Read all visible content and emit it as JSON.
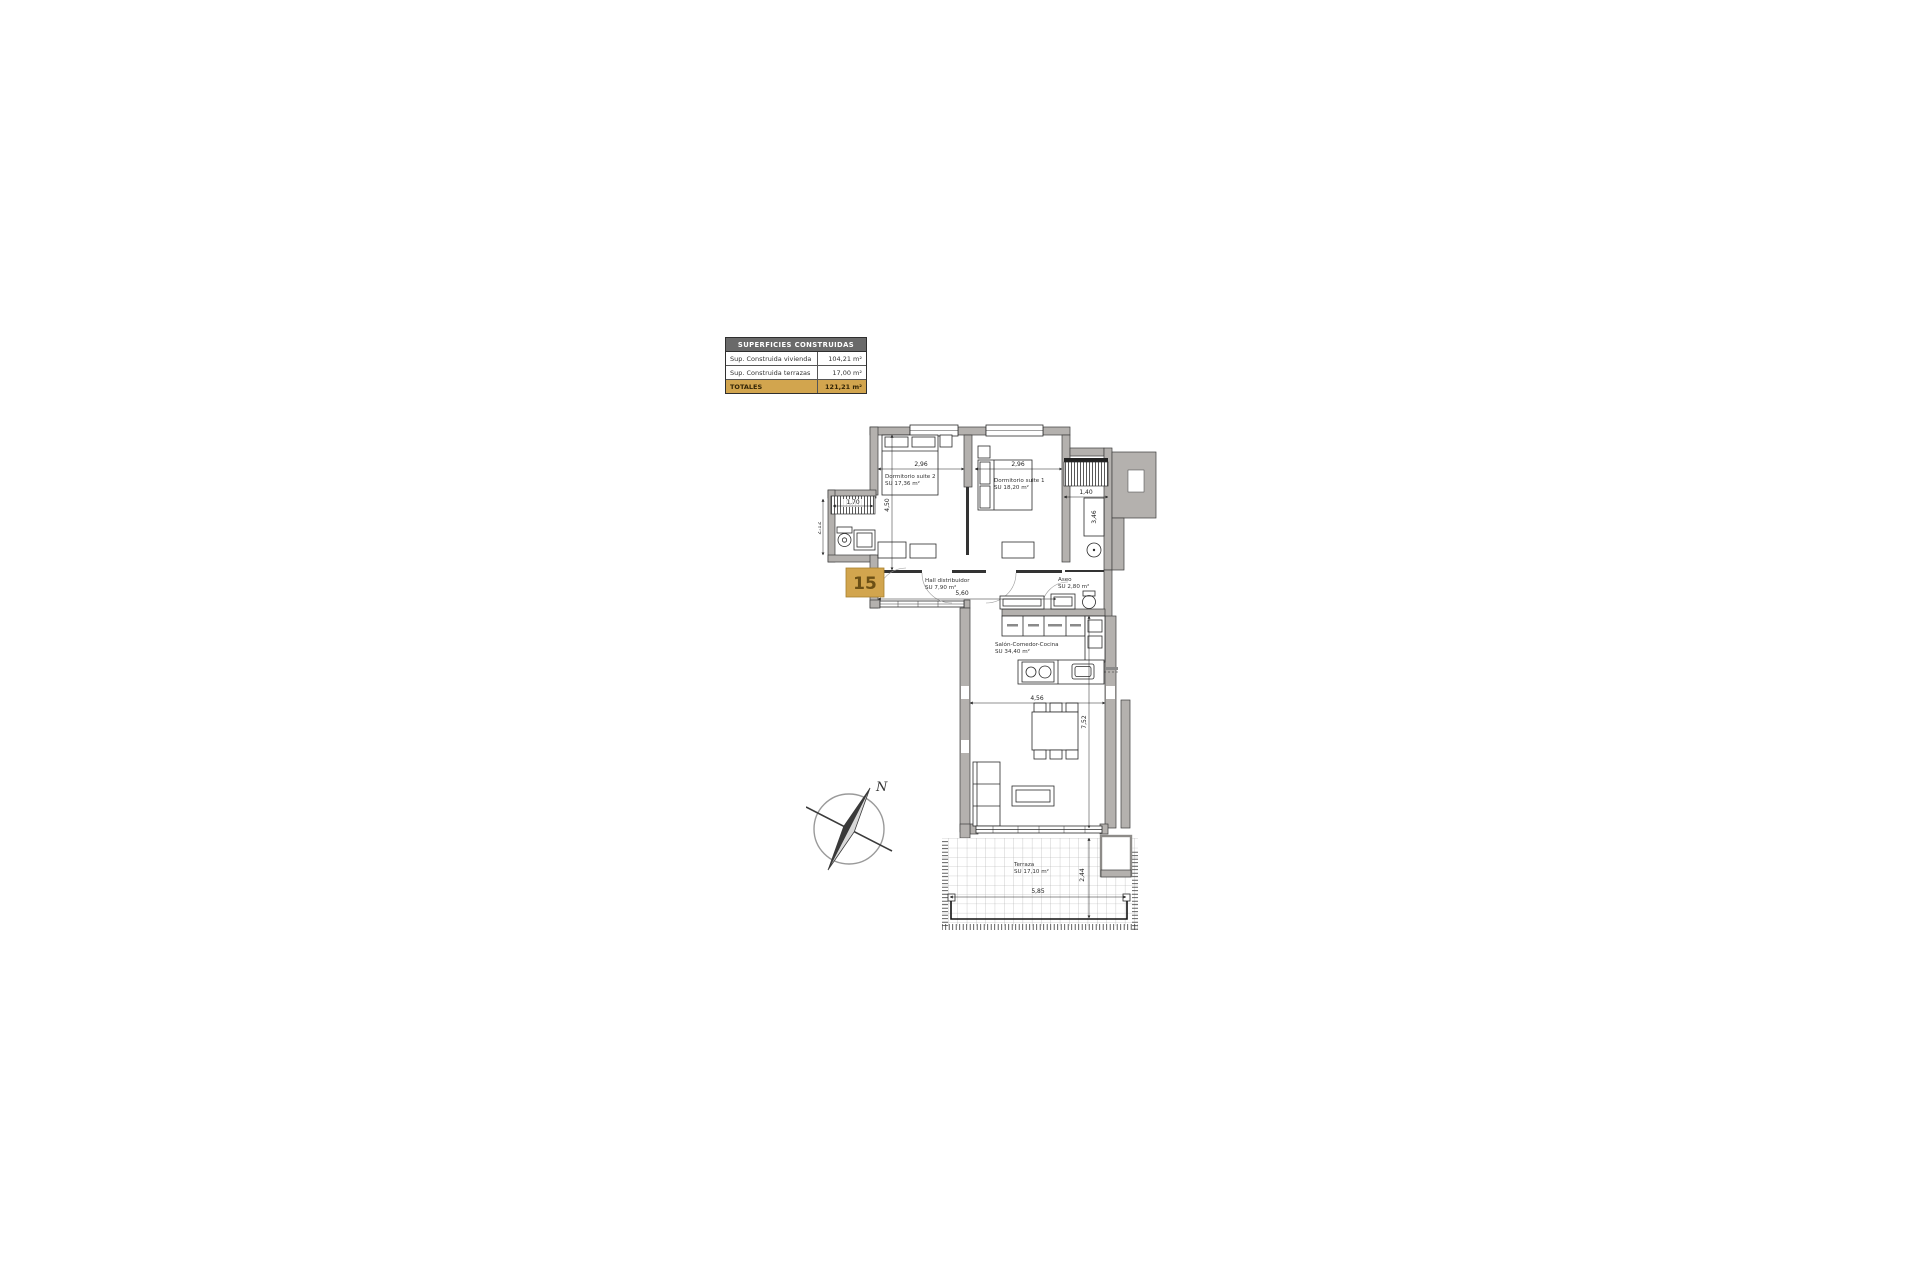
{
  "summary_table": {
    "header": "SUPERFICIES CONSTRUIDAS",
    "rows": [
      {
        "label": "Sup. Construida vivienda",
        "value": "104,21 m²"
      },
      {
        "label": "Sup. Construida terrazas",
        "value": "17,00 m²"
      }
    ],
    "total_row": {
      "label": "TOTALES",
      "value": "121,21 m²"
    }
  },
  "plan": {
    "unit_number": "15",
    "compass_north": "N",
    "rooms": {
      "suite2": {
        "name": "Dormitorio suite 2",
        "area": "SU  17,36 m²"
      },
      "suite1": {
        "name": "Dormitorio suite 1",
        "area": "SU  18,20 m²"
      },
      "hall": {
        "name": "Hall distribuidor",
        "area": "SU  7,90 m²"
      },
      "aseo": {
        "name": "Aseo",
        "area": "SU  2,80 m²"
      },
      "salon": {
        "name": "Salón-Comedor-Cocina",
        "area": "SU  34,40 m²"
      },
      "terraza": {
        "name": "Terraza",
        "area": "SU  17,10 m²"
      }
    },
    "dimensions": {
      "suite2_width": "2,96",
      "suite1_width": "2,96",
      "suite2_depth": "4,50",
      "bath_window": "1,70",
      "bath_depth": "2,12",
      "gallery_width": "1,40",
      "wardrobe_depth": "3,46",
      "hall_width": "5,60",
      "salon_width": "4,56",
      "salon_depth": "7,52",
      "terrace_width": "5,85",
      "terrace_depth": "2,44"
    }
  },
  "colors": {
    "wall_gray": "#b4b1ae",
    "accent_gold": "#d2a54e",
    "table_header_gray": "#6a6a6a"
  }
}
